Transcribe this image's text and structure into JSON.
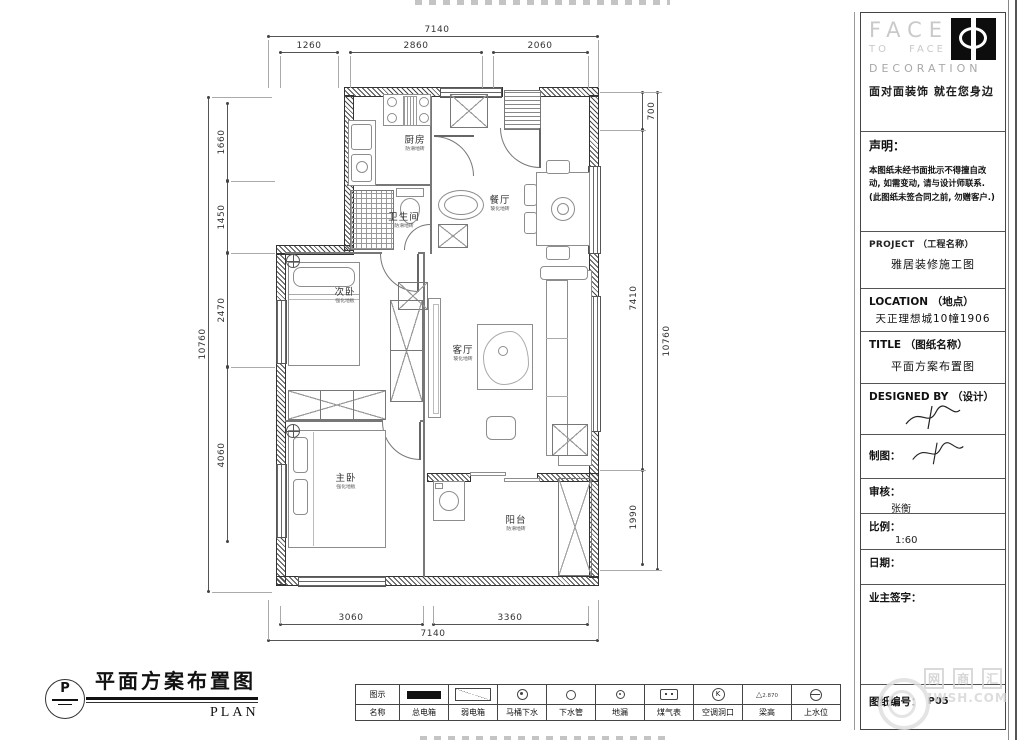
{
  "sheet": {
    "plan_title": "平面方案布置图",
    "plan_subtitle": "PLAN",
    "plan_marker": "P"
  },
  "plan": {
    "rooms": [
      {
        "name": "厨房",
        "material": "防滑地砖"
      },
      {
        "name": "卫生间",
        "material": "防滑地砖"
      },
      {
        "name": "餐厅",
        "material": "玻化地砖"
      },
      {
        "name": "次卧",
        "material": "强化地板"
      },
      {
        "name": "客厅",
        "material": "玻化地砖"
      },
      {
        "name": "主卧",
        "material": "强化地板"
      },
      {
        "name": "阳台",
        "material": "防滑地砖"
      }
    ],
    "dimensions": {
      "top": {
        "overall": "7140",
        "segments": [
          "1260",
          "2860",
          "2060"
        ]
      },
      "bottom": {
        "overall": "7140",
        "segments": [
          "3060",
          "3360"
        ]
      },
      "left": {
        "overall": "10760",
        "segments": [
          "1660",
          "1450",
          "2470",
          "4060"
        ]
      },
      "right": {
        "overall": "10760",
        "segments": [
          "700",
          "7410",
          "1990"
        ]
      }
    }
  },
  "title_block": {
    "brand": {
      "line1": "FACE",
      "line2": "TO FACE",
      "line3": "DECORATION",
      "tagline": "面对面装饰 就在您身边"
    },
    "statement_label": "声明：",
    "statement_text": "本图纸未经书面批示不得擅自改动, 如需变动, 请与设计师联系. (此图纸未签合同之前, 勿赠客户.)",
    "project_label": "PROJECT （工程名称）",
    "project_value": "雅居装修施工图",
    "location_label": "LOCATION （地点）",
    "location_value": "天正理想城10幢1906",
    "title_label": "TITLE （图纸名称）",
    "title_value": "平面方案布置图",
    "designed_label": "DESIGNED BY （设计）",
    "draft_label": "制图：",
    "review_label": "审核：",
    "review_value": "张衡",
    "scale_label": "比例：",
    "scale_value": "1:60",
    "date_label": "日期：",
    "owner_label": "业主签字：",
    "sheet_no_label": "图纸编号：",
    "sheet_no_value": "P05"
  },
  "legend": {
    "symbol_row_label": "图示",
    "name_row_label": "名称",
    "items": [
      {
        "name": "总电箱"
      },
      {
        "name": "弱电箱"
      },
      {
        "name": "马桶下水"
      },
      {
        "name": "下水管"
      },
      {
        "name": "地漏"
      },
      {
        "name": "煤气表"
      },
      {
        "name": "空调洞口",
        "glyph": "K"
      },
      {
        "name": "梁高",
        "glyph": "△",
        "note": "2.870"
      },
      {
        "name": "上水位"
      }
    ]
  },
  "watermark": {
    "chars": [
      "网",
      "商",
      "汇"
    ],
    "domain": "7WSH.COM"
  }
}
